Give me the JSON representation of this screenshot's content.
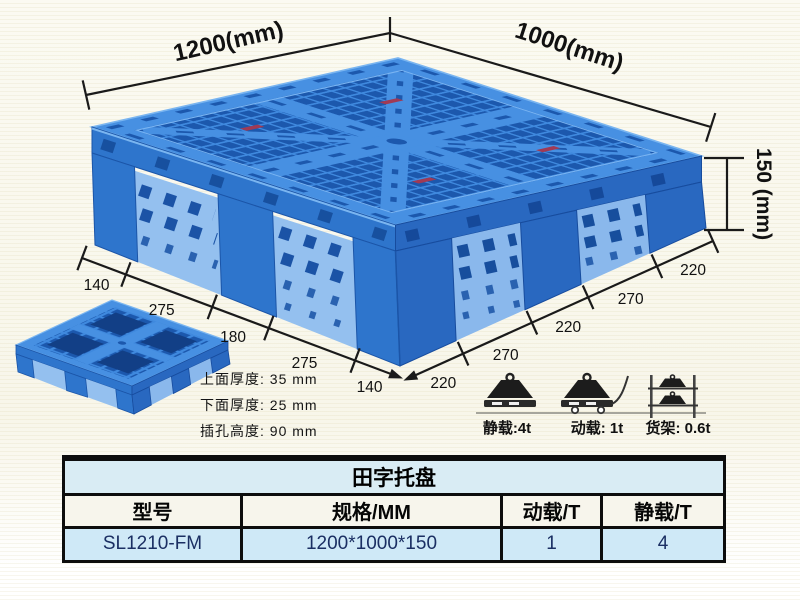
{
  "illustration": {
    "dims": {
      "width": "1200(mm)",
      "depth": "1000(mm)",
      "height": "150 (mm)",
      "left_chain": [
        "140",
        "275",
        "180",
        "275",
        "140"
      ],
      "right_chain": [
        "220",
        "270",
        "220",
        "270",
        "220"
      ]
    },
    "specs": [
      "上面厚度: 35 mm",
      "下面厚度: 25 mm",
      "插孔高度: 90 mm"
    ],
    "loads": [
      {
        "label": "静载:4t",
        "icon": "static-load-weight-icon"
      },
      {
        "label": "动载: 1t",
        "icon": "dynamic-load-trolley-icon"
      },
      {
        "label": "货架: 0.6t",
        "icon": "rack-load-shelf-icon"
      }
    ],
    "colors": {
      "pallet_blue": "#2e75cc",
      "pallet_light_rib": "#3f89de",
      "pallet_dark_slot": "#1c58ad",
      "pallet_pocket": "#8fbdee"
    }
  },
  "table": {
    "title": "田字托盘",
    "headers": [
      "型号",
      "规格/MM",
      "动载/T",
      "静载/T"
    ],
    "rows": [
      [
        "SL1210-FM",
        "1200*1000*150",
        "1",
        "4"
      ]
    ]
  }
}
